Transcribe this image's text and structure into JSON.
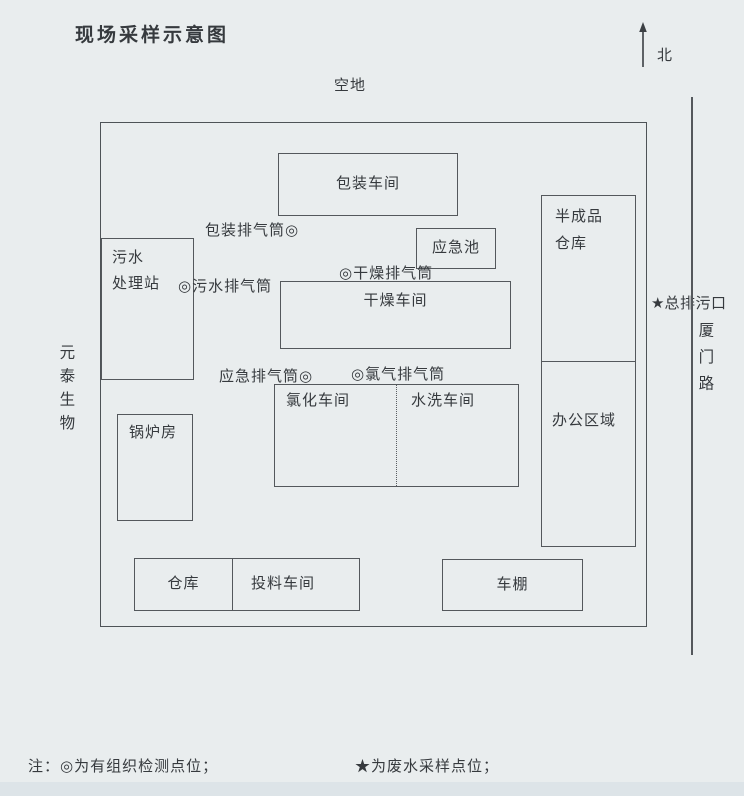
{
  "title": "现场采样示意图",
  "compass": {
    "north": "北"
  },
  "surroundings": {
    "open_space": "空地",
    "west_neighbor": "元泰生物",
    "east_road": "厦门路"
  },
  "outfall": {
    "marker": "★",
    "label": "总排污口"
  },
  "buildings": {
    "packaging_workshop": "包装车间",
    "emergency_pool": "应急池",
    "semi_finished_warehouse": "半成品\n仓库",
    "sewage_treatment_station": "污水\n处理站",
    "drying_workshop": "干燥车间",
    "office_area": "办公区域",
    "chlorination_workshop": "氯化车间",
    "washing_workshop": "水洗车间",
    "boiler_room": "锅炉房",
    "warehouse": "仓库",
    "feeding_workshop": "投料车间",
    "carport": "车棚"
  },
  "exhaust_stacks": {
    "packaging": "包装排气筒◎",
    "sewage": "◎污水排气筒",
    "drying": "◎干燥排气筒",
    "emergency": "应急排气筒◎",
    "chlorine": "◎氯气排气筒"
  },
  "notes": {
    "organized_points": "注：◎为有组织检测点位；",
    "wastewater_points": "★为废水采样点位；"
  },
  "colors": {
    "paper": "#e9edee",
    "line": "#54585c",
    "ink": "#363a3e"
  }
}
